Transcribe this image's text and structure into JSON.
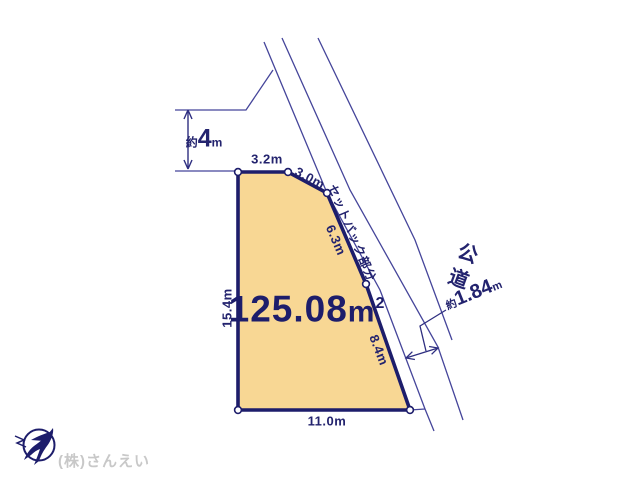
{
  "diagram": {
    "area": {
      "value": "125.08",
      "unit": "m",
      "sup": "2"
    },
    "dimensions": {
      "top": "3.2m",
      "chamfer": "3.0m",
      "mid_right": "6.3m",
      "lower_right": "8.4m",
      "left": "15.4m",
      "bottom": "11.0m"
    },
    "north_gap": {
      "prefix": "約",
      "value": "4",
      "unit": "m"
    },
    "road_gap": {
      "prefix": "約",
      "value": "1.84",
      "unit": "m"
    },
    "setback_label": "セットバック部分",
    "road_label_chars": [
      "公",
      "道"
    ]
  },
  "footer": {
    "company": "(株)さんえい"
  },
  "colors": {
    "plot_fill": "#f8d794",
    "plot_border": "#1d1d6b",
    "thin_line": "#45459a",
    "text_navy": "#23236e",
    "company_gray": "#c8c8c8"
  }
}
